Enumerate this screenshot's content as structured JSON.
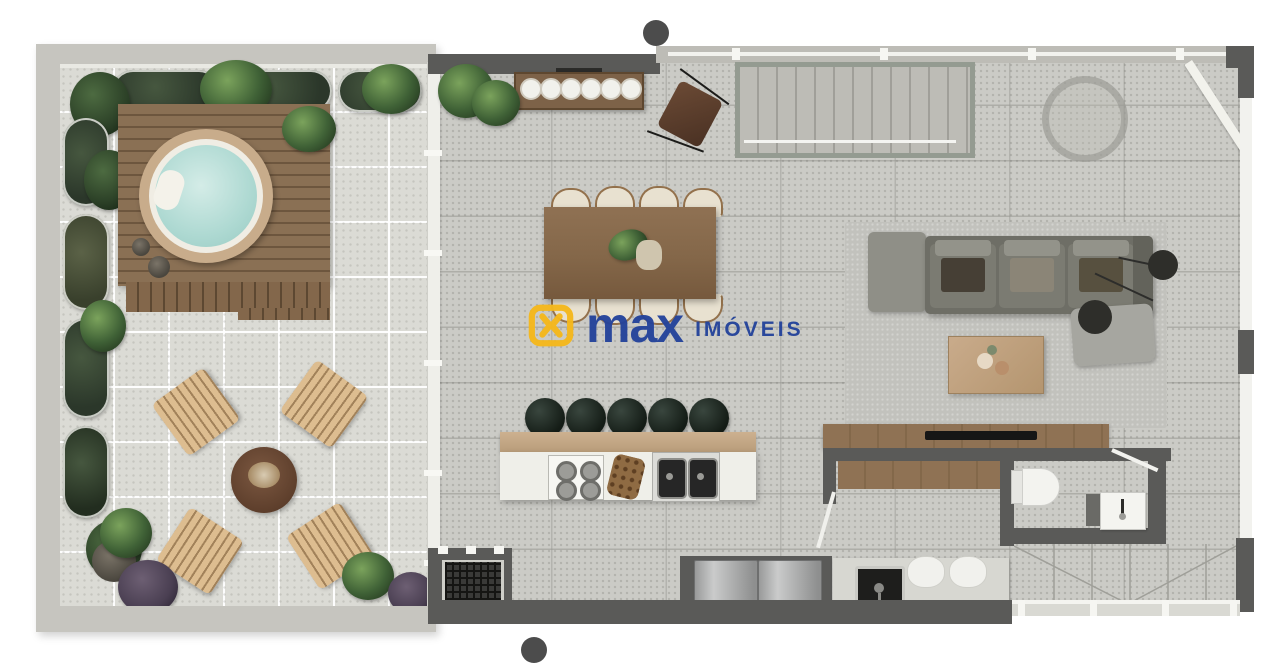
{
  "scene": {
    "type": "apartment-floor-plan-render",
    "background": "#ffffff"
  },
  "watermark": {
    "brand": "max",
    "suffix": "IMÓVEIS",
    "icon": "max-monogram-icon",
    "icon_color": "#F5B81C",
    "text_color": "#24439B"
  },
  "section_markers": {
    "count": 2,
    "color": "#4C4C4C"
  },
  "palette": {
    "terrace_floor": "#DBDBD5",
    "interior_floor": "#CBCBC6",
    "deck_wood": "#8A7054",
    "jacuzzi_water": "#B5DDD6",
    "jacuzzi_rim": "#C8AC8B",
    "wall_dark": "#5A5A58",
    "wall_light": "#C6C5BF",
    "sofa": "#6E6E66",
    "rug": "#C1C1BC",
    "counter_wood": "#8A6E50",
    "island_bar_wood": "#C6AA87",
    "lounge_chair_wood": "#D8B98E",
    "dining_table_wood": "#8A6C4F",
    "plant_green": "#3C4F37",
    "stool_dark": "#222B25",
    "appliance_steel": "#A9AAAA"
  }
}
